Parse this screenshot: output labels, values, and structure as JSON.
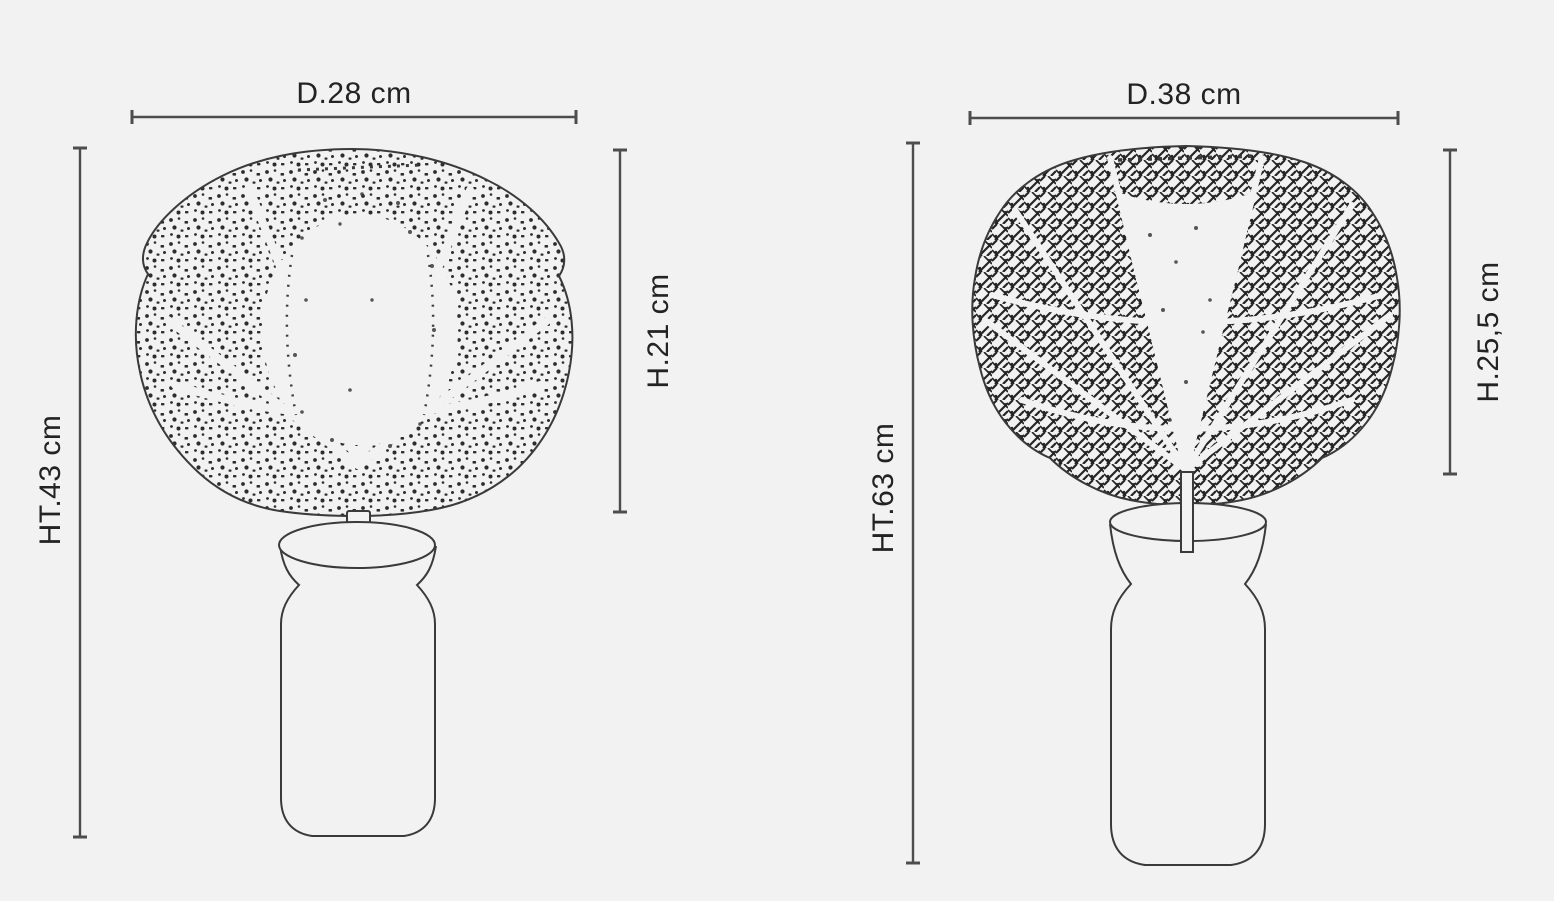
{
  "figure": {
    "colors": {
      "background": "#f2f2f2",
      "line": "#3a3a3a",
      "dimension_line": "#4d4d4d",
      "text": "#232323"
    },
    "lamps": [
      {
        "dimensions": {
          "diameter": "D.28 cm",
          "total_height": "HT.43 cm",
          "shade_height": "H.21 cm"
        }
      },
      {
        "dimensions": {
          "diameter": "D.38 cm",
          "total_height": "HT.63 cm",
          "shade_height": "H.25,5 cm"
        }
      }
    ]
  }
}
